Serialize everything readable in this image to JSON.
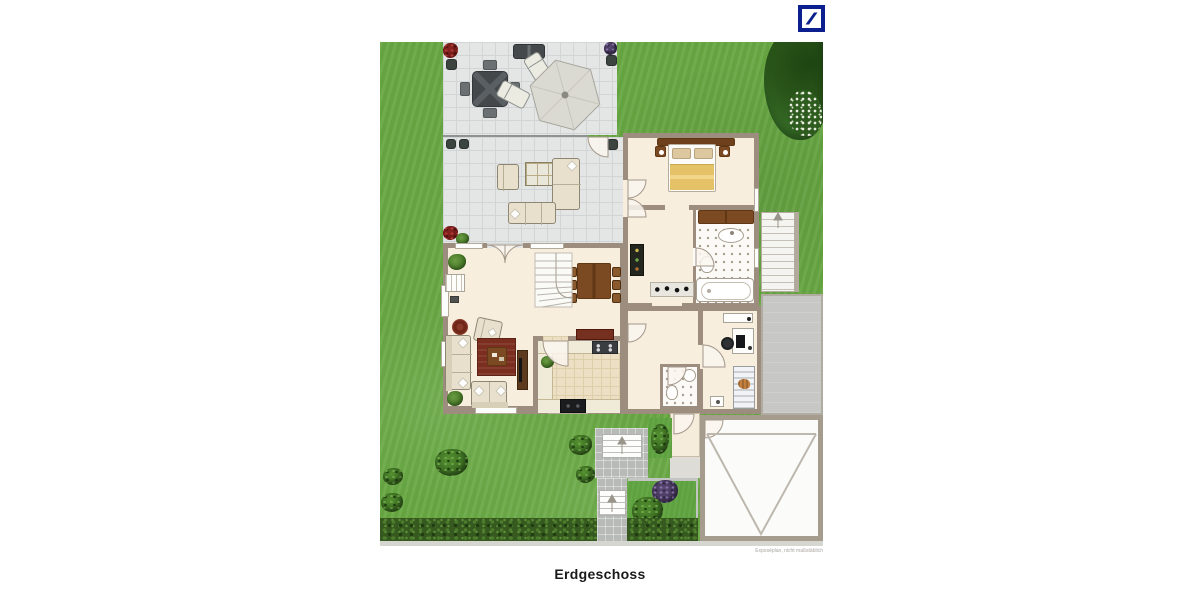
{
  "branding": {
    "logo_name": "Deutsche Bank logo"
  },
  "caption": "Erdgeschoss",
  "watermark": "Exposéplan, nicht maßstäblich",
  "palette": {
    "db_blue": "#0c1f8e",
    "grass": "#68a843",
    "hedge": "#35591f",
    "terrace_tile": "#e4e6e6",
    "terrace_line": "#d2d5d6",
    "wall": "#9c8d7e",
    "floor": "#f8eedd",
    "floor_kitchen": "#ecdfc3",
    "bath_floor": "#fbfaf6",
    "bath_dot": "#a79d8e",
    "drive": "#c7c8c6",
    "garage": "#fbfbf9",
    "path": "#b7bab7",
    "wood": "#7c4a22",
    "wood_dark": "#5f3714",
    "red_rug": "#7b2e1f",
    "cream": "#e8e0cd",
    "dark_furniture": "#46494c",
    "blanket_yellow": "#e5c268"
  }
}
